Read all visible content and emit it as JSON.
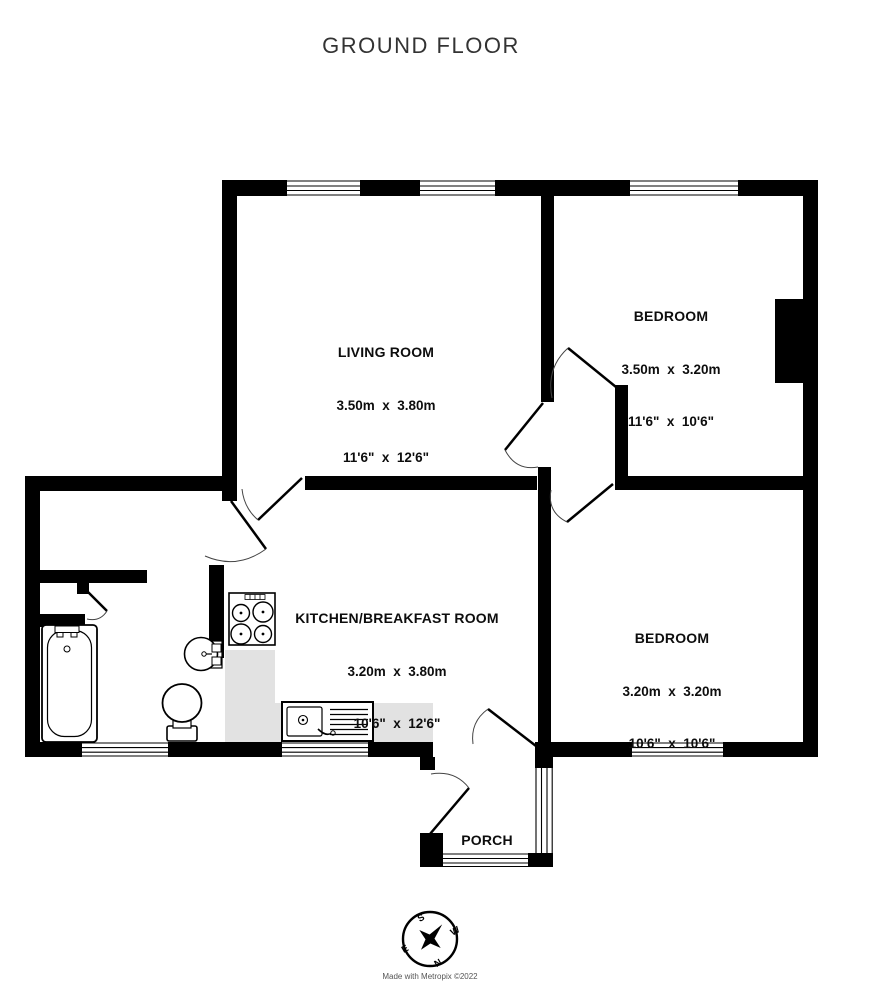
{
  "title": "GROUND FLOOR",
  "rooms": [
    {
      "name": "LIVING ROOM",
      "metric": "3.50m  x  3.80m",
      "imperial": "11'6\"  x  12'6\""
    },
    {
      "name": "BEDROOM",
      "metric": "3.50m  x  3.20m",
      "imperial": "11'6\"  x  10'6\""
    },
    {
      "name": "KITCHEN/BREAKFAST ROOM",
      "metric": "3.20m  x  3.80m",
      "imperial": "10'6\"  x  12'6\""
    },
    {
      "name": "BEDROOM",
      "metric": "3.20m  x  3.20m",
      "imperial": "10'6\"  x  10'6\""
    },
    {
      "name": "PORCH"
    }
  ],
  "compass": {
    "north": "N",
    "south": "S",
    "east": "E",
    "west": "W"
  },
  "credit": "Made with Metropix ©2022",
  "colors": {
    "wall": "#000000",
    "counter": "#e2e2e2",
    "background": "#ffffff"
  }
}
